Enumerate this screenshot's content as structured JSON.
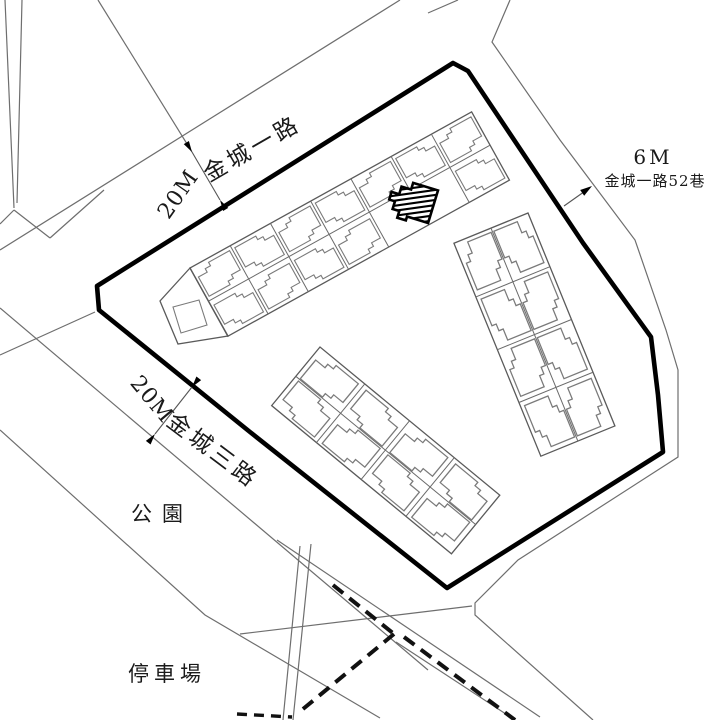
{
  "map": {
    "roads": {
      "jincheng_1st": {
        "width_label": "20M",
        "name": "金城一路"
      },
      "jincheng_3rd": {
        "width_label": "20M",
        "name": "金城三路"
      },
      "lane_52": {
        "width_label": "6M",
        "name": "金城一路52巷"
      }
    },
    "areas": {
      "park": "公園",
      "parking_lot": "停車場"
    },
    "colors": {
      "boundary": "#000000",
      "road_line": "#6e6e6e",
      "building_line": "#7a7a7a",
      "background": "#ffffff"
    }
  }
}
